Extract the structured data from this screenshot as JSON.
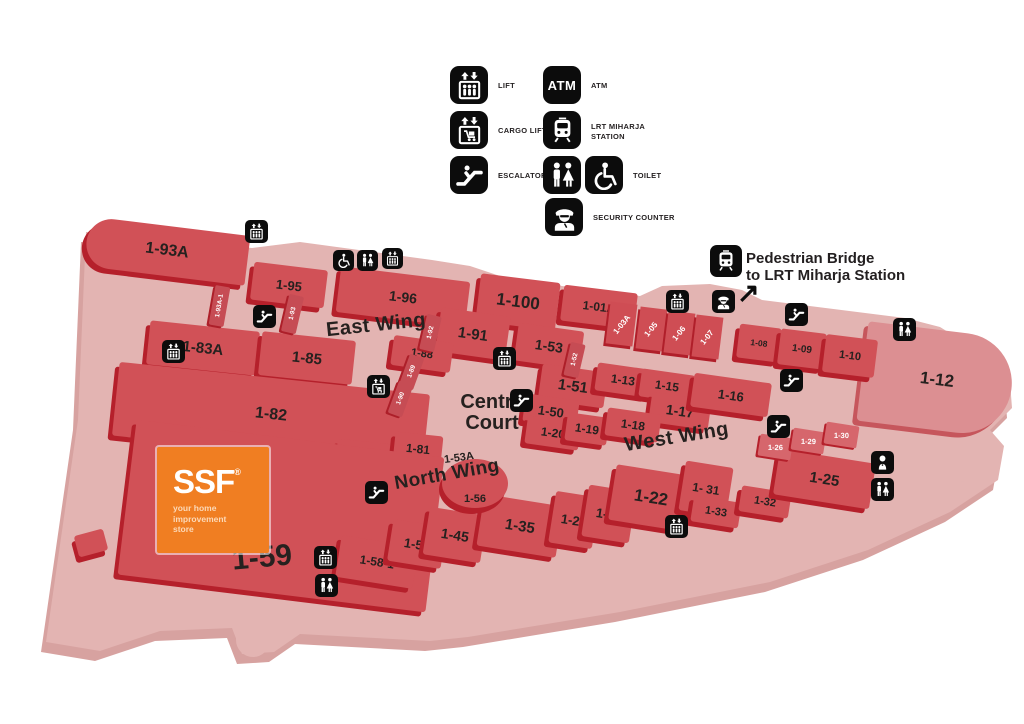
{
  "legend": {
    "items": [
      {
        "id": "lift",
        "label": "LIFT"
      },
      {
        "id": "atm",
        "label": "ATM",
        "icon_label": "ATM"
      },
      {
        "id": "cargo-lift",
        "label": "CARGO LIFT"
      },
      {
        "id": "lrt-miharja-station",
        "label": "LRT MIHARJA STATION"
      },
      {
        "id": "escalator",
        "label": "ESCALATOR"
      },
      {
        "id": "toilet",
        "label": "TOILET"
      },
      {
        "id": "security-counter",
        "label": "SECURITY COUNTER"
      }
    ]
  },
  "bridge": {
    "line1": "Pedestrian Bridge",
    "line2": "to LRT Miharja Station",
    "arrow": "↗"
  },
  "wings": {
    "east": "East Wing",
    "west": "West Wing",
    "north": "North Wing",
    "centre_line1": "Centre",
    "centre_line2": "Court"
  },
  "ssf": {
    "name": "SSF",
    "reg": "®",
    "tagline": "your home improvement store"
  },
  "units": {
    "93A": "1-93A",
    "93A1": "1-93A-1",
    "95": "1-95",
    "93": "1-93",
    "96": "1-96",
    "100": "1-100",
    "01A": "1-01A",
    "91": "1-91",
    "92": "1-92",
    "53": "1-53",
    "52": "1-52",
    "03A": "1-03A",
    "05": "1-05",
    "06": "1-06",
    "07": "1-07",
    "08": "1-08",
    "09": "1-09",
    "10": "1-10",
    "12": "1-12",
    "83A": "1-83A",
    "85": "1-85",
    "88": "1-88",
    "89": "1-89",
    "90": "1-90",
    "82": "1-82",
    "51": "1-51",
    "50": "1-50",
    "13": "1-13",
    "15": "1-15",
    "16": "1-16",
    "17": "1-17",
    "20": "1-20",
    "19": "1-19",
    "18": "1-18",
    "80": "1-80",
    "81": "1-81",
    "53A": "1-53A",
    "56": "1-56",
    "59": "1-59",
    "58": "1-58",
    "581": "1-58-1",
    "45": "1-45",
    "35": "1-35",
    "21": "1-21",
    "40": "1-40",
    "22": "1-22",
    "31": "1- 31",
    "33": "1-33",
    "32": "1-32",
    "25": "1-25",
    "26": "1-26",
    "29": "1-29",
    "30": "1-30"
  },
  "colors": {
    "unit_red": "#d15157",
    "unit_side_red": "#b5202b",
    "floor_pink": "#e3b4b2",
    "unit_light_pink": "#dc8f92",
    "ssf_orange": "#f07e22",
    "icon_black": "#0c0c0c"
  }
}
